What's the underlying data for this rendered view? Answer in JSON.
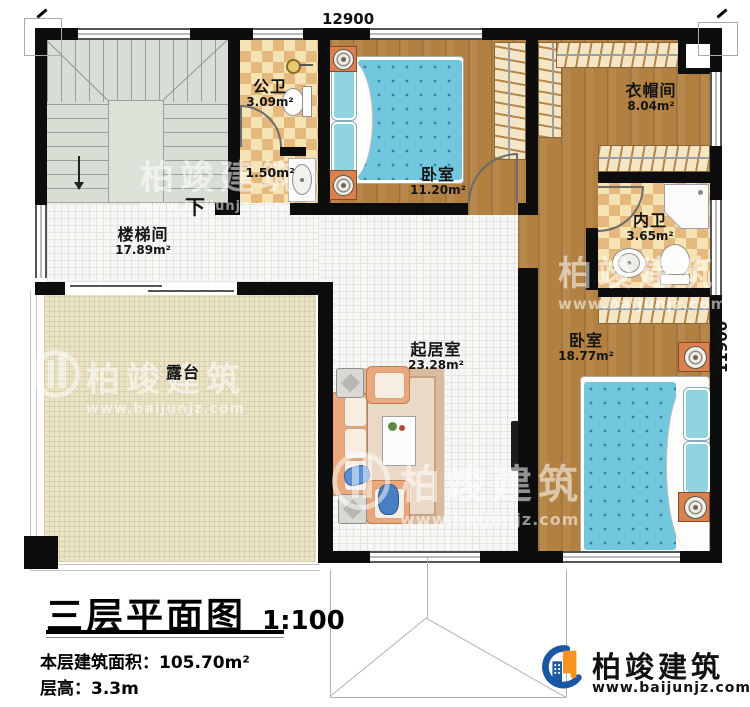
{
  "plan": {
    "dim_top": "12900",
    "dim_right": "11900",
    "stair_down_label": "下"
  },
  "rooms": {
    "gongwei": {
      "name": "公卫",
      "area": "3.09m²"
    },
    "hall_small": {
      "area": "1.50m²"
    },
    "bedroom_top": {
      "name": "卧室",
      "area": "11.20m²"
    },
    "cloakroom": {
      "name": "衣帽间",
      "area": "8.04m²"
    },
    "neiwei": {
      "name": "内卫",
      "area": "3.65m²"
    },
    "stair_hall": {
      "name": "楼梯间",
      "area": "17.89m²"
    },
    "terrace": {
      "name": "露台"
    },
    "living": {
      "name": "起居室",
      "area": "23.28m²"
    },
    "bedroom_right": {
      "name": "卧室",
      "area": "18.77m²"
    }
  },
  "titleblock": {
    "title": "三层平面图",
    "scale": "1:100",
    "area_line": "本层建筑面积：105.70m²",
    "height_line": "层高：3.3m"
  },
  "brand": {
    "name": "柏竣建筑",
    "url": "www.baijunjz.com"
  },
  "watermark": {
    "name": "柏竣建筑",
    "url": "www.baijunjz.com"
  },
  "colors": {
    "wall": "#0d0d0d",
    "wood": "#b28040",
    "checker_light": "#f6e3b4",
    "checker_dark": "#e5b97e",
    "tile": "#f7f7f5",
    "terrace": "#ebe3c6",
    "stair": "#d9ded5",
    "bed": "#72c6de",
    "sofa": "#eba87c",
    "brand_blue": "#1a57a5",
    "brand_orange": "#f6921e"
  }
}
